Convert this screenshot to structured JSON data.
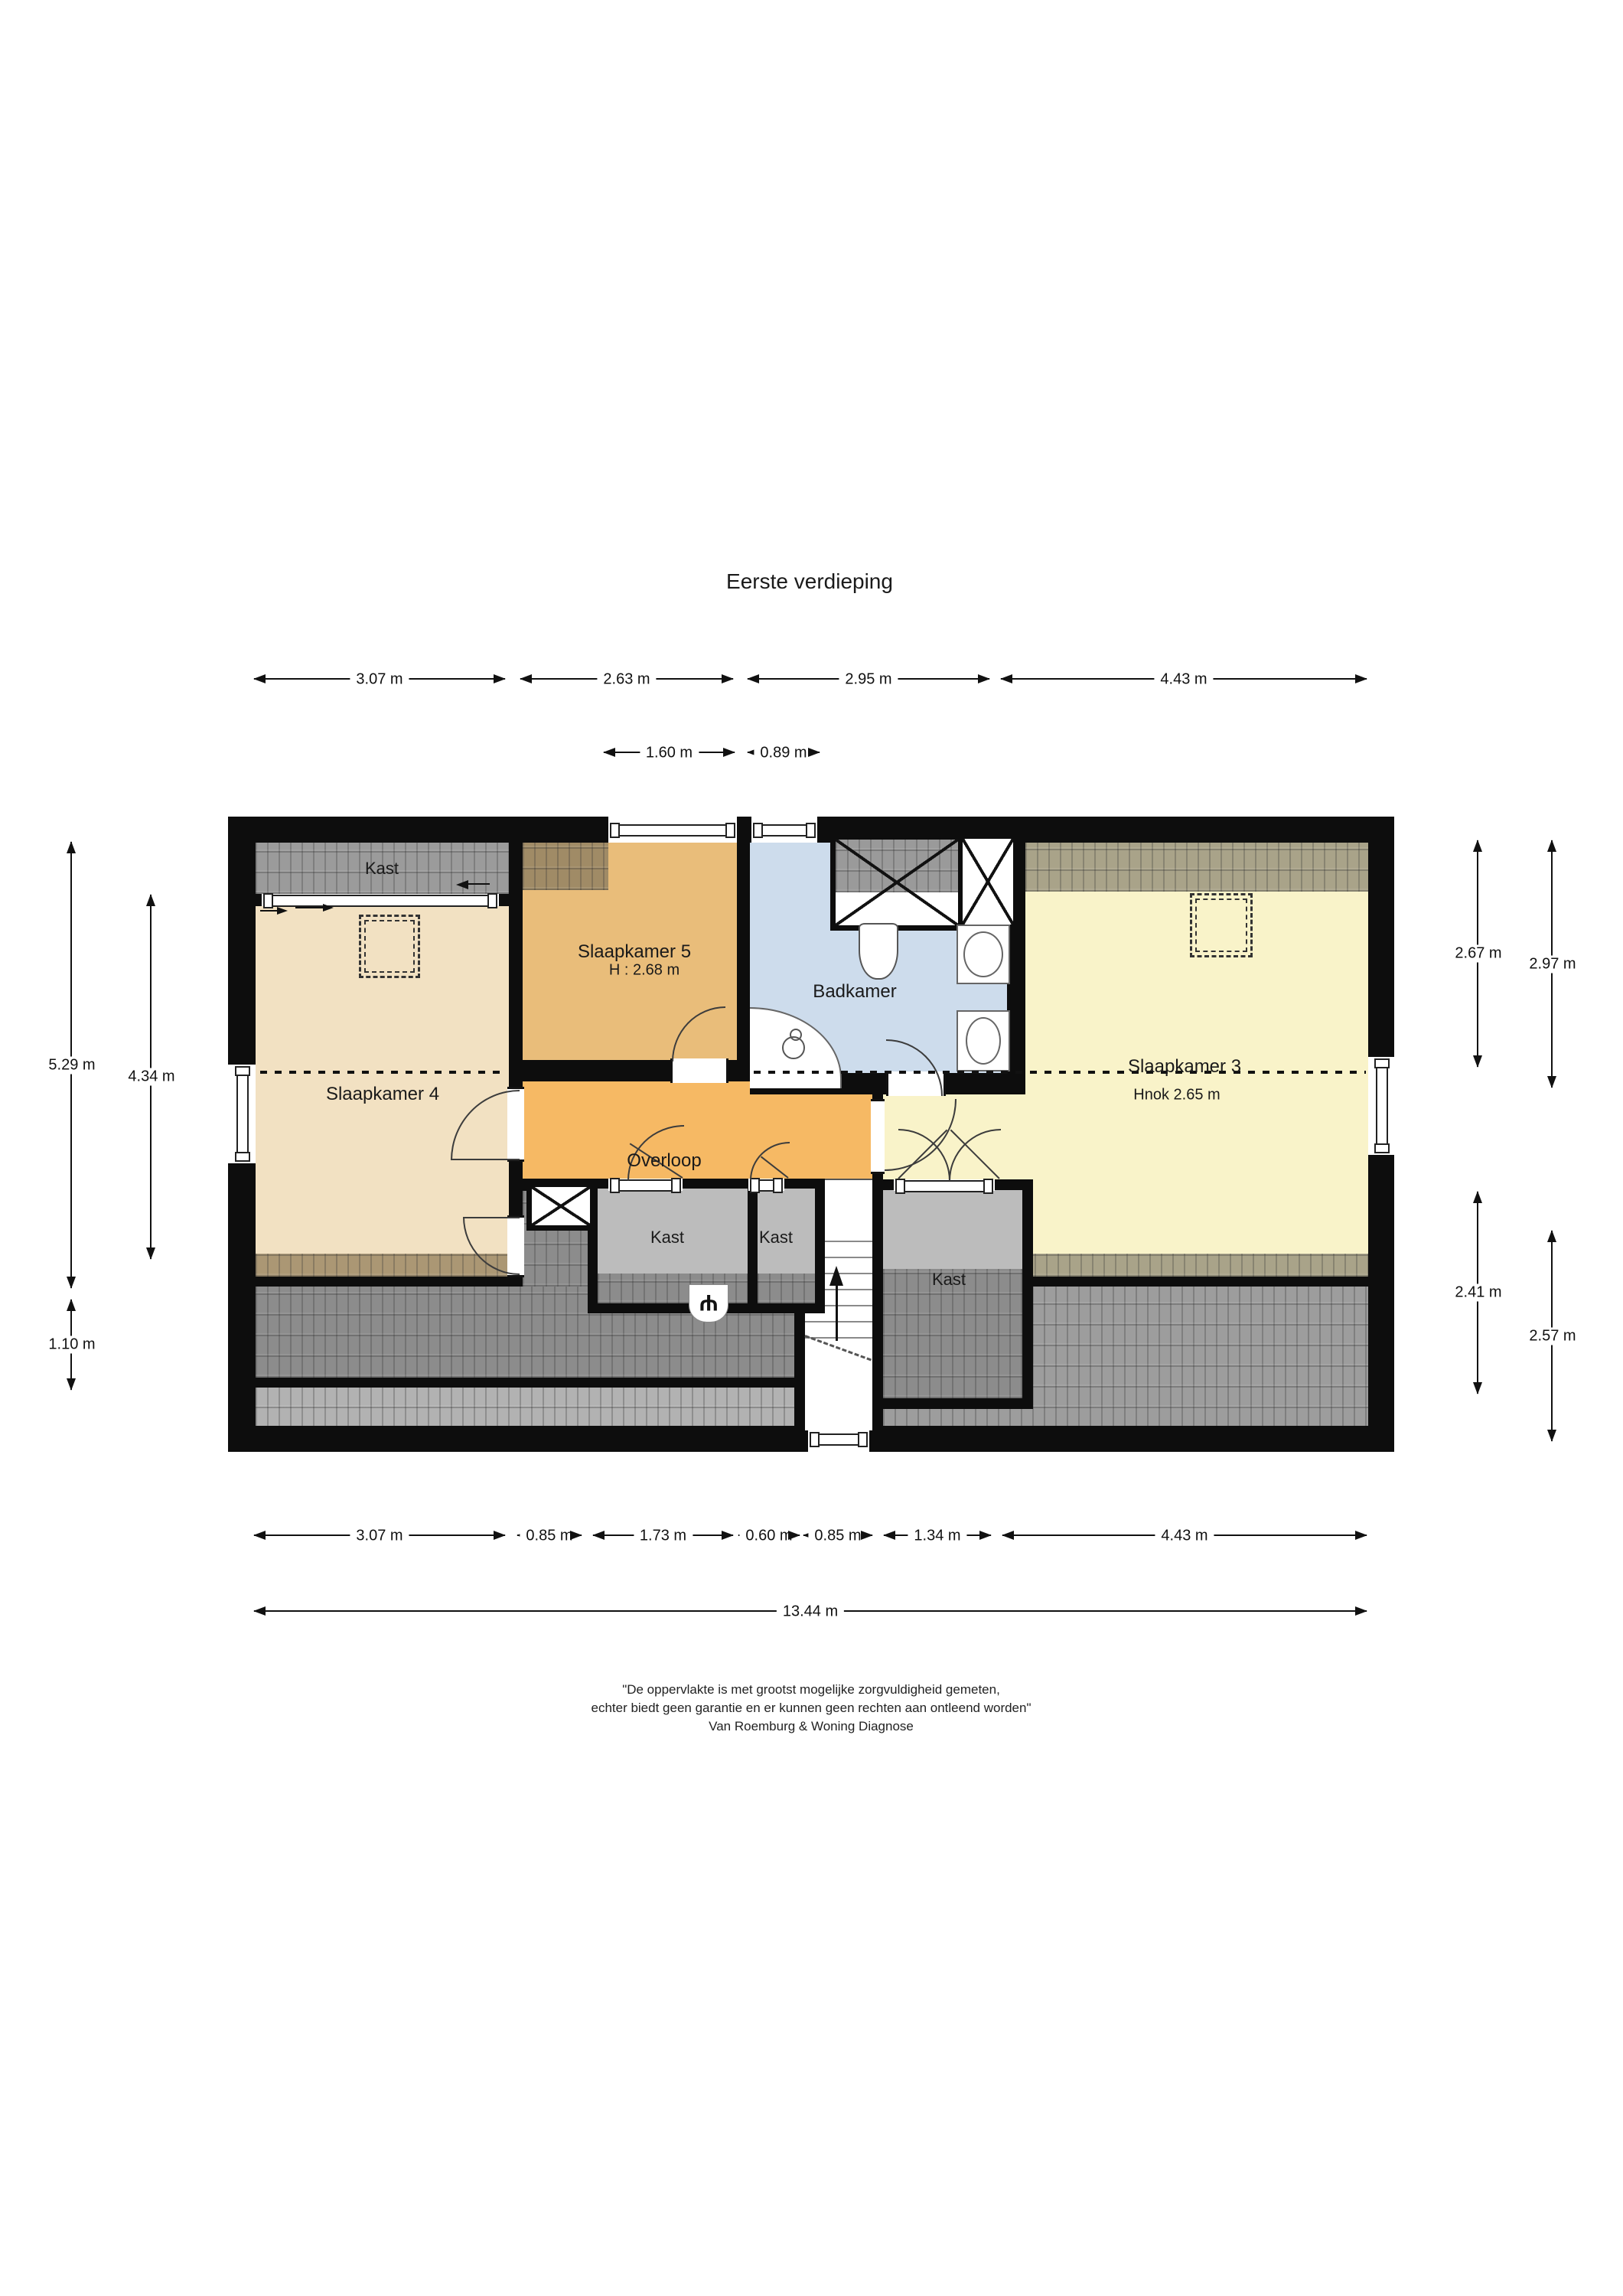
{
  "title": "Eerste verdieping",
  "rooms": {
    "kast_tl": {
      "label": "Kast"
    },
    "slaapkamer4": {
      "label": "Slaapkamer 4"
    },
    "slaapkamer5": {
      "label": "Slaapkamer 5",
      "height": "H : 2.68 m"
    },
    "badkamer": {
      "label": "Badkamer"
    },
    "slaapkamer3": {
      "label": "Slaapkamer 3",
      "height": "Hnok 2.65 m"
    },
    "overloop": {
      "label": "Overloop"
    },
    "kast_center": {
      "label": "Kast"
    },
    "kast_small": {
      "label": "Kast"
    },
    "kast_stairs": {
      "label": "Kast"
    }
  },
  "dims": {
    "t1": "3.07 m",
    "t2": "2.63 m",
    "t3": "2.95 m",
    "t4": "4.43 m",
    "t5": "1.60 m",
    "t6": "0.89 m",
    "l1": "5.29 m",
    "l2": "4.34 m",
    "l3": "1.10 m",
    "r1": "2.67 m",
    "r2": "2.97 m",
    "r3": "2.41 m",
    "r4": "2.57 m",
    "b1": "3.07 m",
    "b2": "0.85 m",
    "b3": "1.73 m",
    "b4": "0.60 m",
    "b5": "0.85 m",
    "b6": "1.34 m",
    "b7": "4.43 m",
    "total": "13.44 m"
  },
  "disclaimer": {
    "line1": "\"De oppervlakte is met grootst mogelijke zorgvuldigheid gemeten,",
    "line2": "echter biedt geen garantie en er kunnen geen rechten aan ontleend worden\"",
    "line3": "Van Roemburg & Woning Diagnose"
  },
  "colors": {
    "wall": "#0d0d0d",
    "slaapkamer4": "#f2e1c2",
    "slaapkamer5": "#e9bd7a",
    "overloop": "#f6b964",
    "badkamer": "#cddcec",
    "slaapkamer3": "#f9f3c9",
    "kast": "#bcbcbc",
    "roof_dark": "#8c8c8c",
    "roof_light": "#b2b2b2",
    "roof_right": "#9d9d9d",
    "roof_beige": "#ab9774",
    "roof_olive": "#a9a389",
    "roof_top_left": "#9b9b9b"
  }
}
